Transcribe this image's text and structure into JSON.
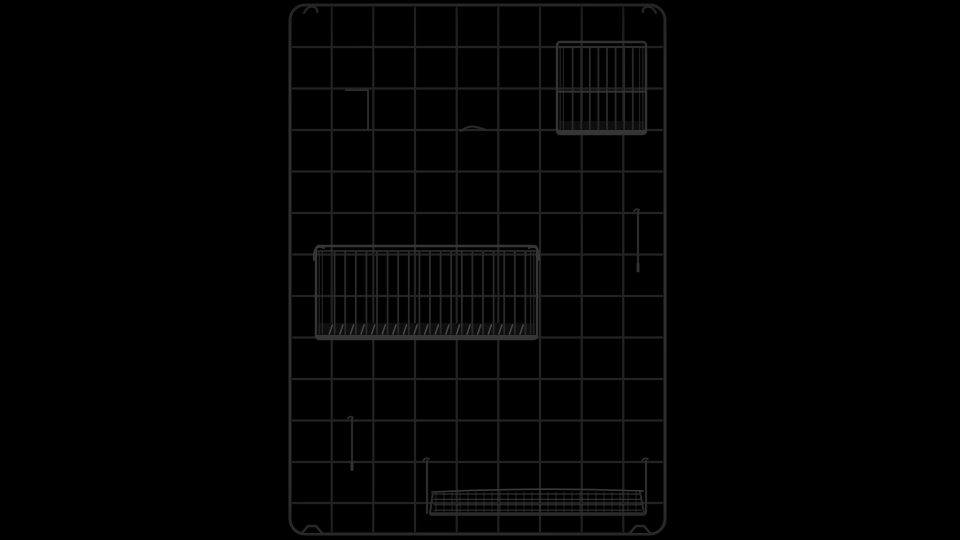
{
  "meta": {
    "description": "Black metal wire-grid wall organizer panel with a small hanging wire basket, a large hanging wire basket, two wire hooks, a hook clip and a wire shelf tray, rendered on a pure black background",
    "background_color": "#000000"
  },
  "canvas": {
    "width": 960,
    "height": 540
  },
  "colors": {
    "frame": "#303030",
    "grid_wire": "#242424",
    "basket_rim": "#363636",
    "basket_bar": "#2b2b2b",
    "basket_floor_tick": "#4a4a4a",
    "basket_bottom_fill": "#0f0f0f",
    "basket_bottom_edge": "#383838",
    "shelf_wire": "#2e2e2e",
    "shelf_mesh": "#3c3c3c",
    "hook_wire": "#2b2b2b"
  },
  "panel": {
    "label": "wire-grid-panel",
    "x": 290,
    "y": 5,
    "width": 375,
    "height": 529,
    "corner_radius": 15,
    "frame_width": 3,
    "wire_width": 2.2,
    "columns_x": [
      331.7,
      373.3,
      415.0,
      456.7,
      498.3,
      540.0,
      581.7,
      623.3
    ],
    "rows_y": [
      47,
      88.5,
      130,
      171.5,
      213,
      254.5,
      296,
      337.5,
      379,
      420.5,
      462,
      503
    ],
    "mount_hooks": [
      {
        "x": 304,
        "y": 4,
        "dir": 1
      },
      {
        "x": 656,
        "y": 4,
        "dir": -1
      }
    ],
    "feet_x": [
      312,
      640
    ]
  },
  "baskets": [
    {
      "label": "small-wire-basket",
      "x": 557,
      "y": 42,
      "width": 89,
      "height": 92,
      "side_depth": 7,
      "bar_spacing": 8.6,
      "mid_rail_ratio": 0.54,
      "bottom_band": 13,
      "corner_hooks": false,
      "floor_ticks": false
    },
    {
      "label": "large-wire-basket",
      "x": 316,
      "y": 246,
      "width": 221,
      "height": 93,
      "side_depth": 8,
      "bar_spacing": 10.6,
      "mid_rail_ratio": null,
      "bottom_band": 16,
      "corner_hooks": true,
      "floor_ticks": true
    }
  ],
  "shelf": {
    "label": "wire-shelf-tray",
    "x": 427,
    "y": 459,
    "width": 221,
    "platform_y": 489,
    "platform_height": 27,
    "hook_xs": [
      427,
      646
    ],
    "mesh_rows": 4,
    "mesh_col_step": 8
  },
  "hooks": [
    {
      "label": "wire-hook",
      "x": 352,
      "top_y": 420.5,
      "length": 49,
      "arm": null
    },
    {
      "label": "wire-hook",
      "x": 638,
      "top_y": 213,
      "length": 58,
      "arm": null
    },
    {
      "label": "wire-hook",
      "x": 346,
      "top_y": 88.5,
      "length": 40,
      "arm": 22
    }
  ],
  "clips": [
    {
      "label": "wire-clip",
      "x": 461,
      "y": 130,
      "width": 25
    }
  ]
}
